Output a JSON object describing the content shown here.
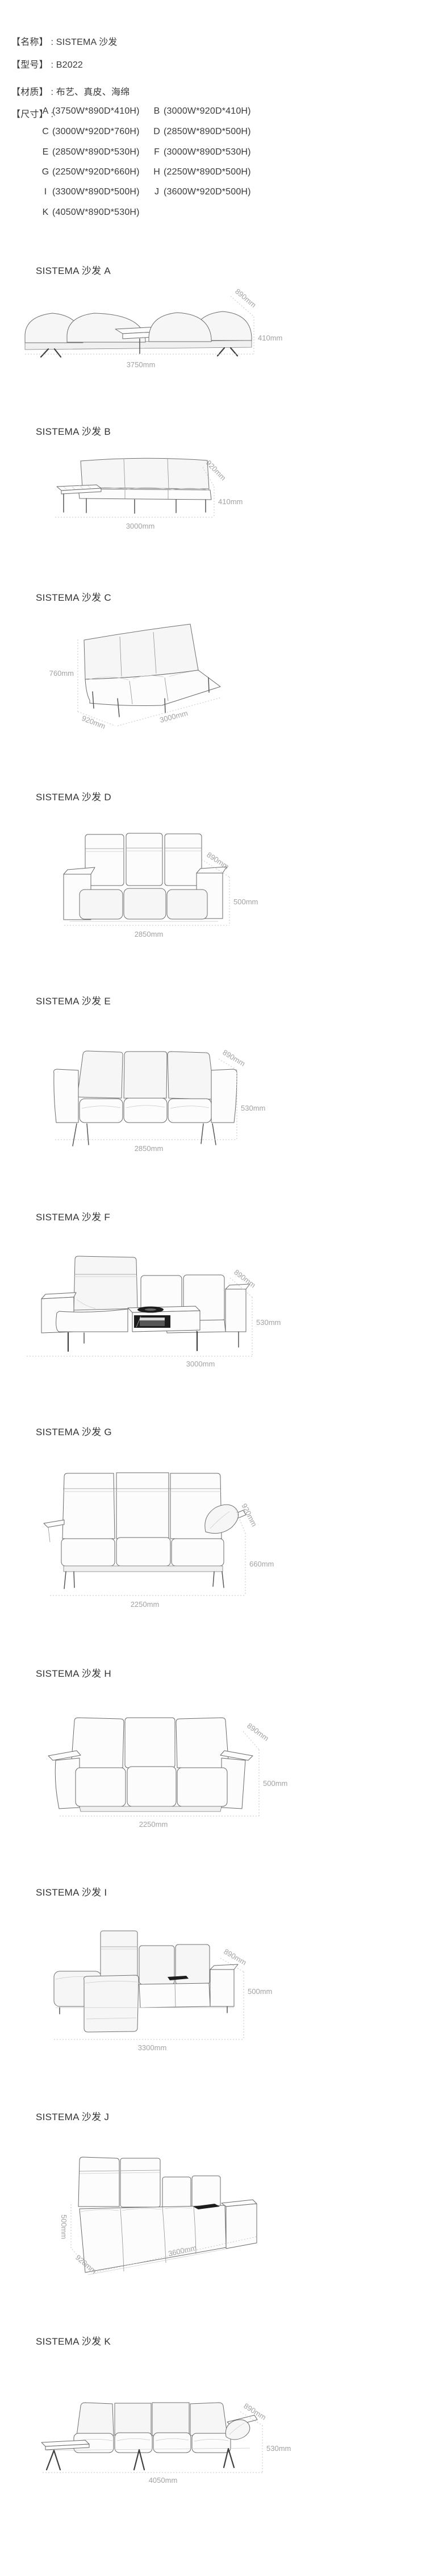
{
  "palette": {
    "text_color": "#3a3a3a",
    "dim_label_color": "#a2a2a2",
    "line_art_color": "#686868",
    "background": "#ffffff"
  },
  "header": {
    "rows": [
      {
        "label": "【名称】",
        "sep": " : ",
        "value": "SISTEMA 沙发"
      },
      {
        "label": "【型号】",
        "sep": " : ",
        "value": "B2022"
      },
      {
        "label": "【材质】",
        "sep": " : ",
        "value": "布艺、真皮、海绵"
      }
    ],
    "size_label": "【尺寸】",
    "size_sep": " : ",
    "sizes": [
      {
        "key": "A",
        "dims": "(3750W*890D*410H)"
      },
      {
        "key": "B",
        "dims": "(3000W*920D*410H)"
      },
      {
        "key": "C",
        "dims": "(3000W*920D*760H)"
      },
      {
        "key": "D",
        "dims": "(2850W*890D*500H)"
      },
      {
        "key": "E",
        "dims": "(2850W*890D*530H)"
      },
      {
        "key": "F",
        "dims": "(3000W*890D*530H)"
      },
      {
        "key": "G",
        "dims": "(2250W*920D*660H)"
      },
      {
        "key": "H",
        "dims": "(2250W*890D*500H)"
      },
      {
        "key": "I",
        "dims": "(3300W*890D*500H)"
      },
      {
        "key": "J",
        "dims": "(3600W*920D*500H)"
      },
      {
        "key": "K",
        "dims": "(4050W*890D*530H)"
      }
    ]
  },
  "sections": [
    {
      "id": "A",
      "title": "SISTEMA 沙发 A",
      "width": "3750mm",
      "depth": "890mm",
      "height": "410mm"
    },
    {
      "id": "B",
      "title": "SISTEMA 沙发 B",
      "width": "3000mm",
      "depth": "920mm",
      "height": "410mm"
    },
    {
      "id": "C",
      "title": "SISTEMA 沙发 C",
      "width": "3000mm",
      "depth": "920mm",
      "height": "760mm"
    },
    {
      "id": "D",
      "title": "SISTEMA 沙发 D",
      "width": "2850mm",
      "depth": "890mm",
      "height": "500mm"
    },
    {
      "id": "E",
      "title": "SISTEMA 沙发 E",
      "width": "2850mm",
      "depth": "890mm",
      "height": "530mm"
    },
    {
      "id": "F",
      "title": "SISTEMA 沙发 F",
      "width": "3000mm",
      "depth": "890mm",
      "height": "530mm"
    },
    {
      "id": "G",
      "title": "SISTEMA 沙发 G",
      "width": "2250mm",
      "depth": "920mm",
      "height": "660mm"
    },
    {
      "id": "H",
      "title": "SISTEMA 沙发 H",
      "width": "2250mm",
      "depth": "890mm",
      "height": "500mm"
    },
    {
      "id": "I",
      "title": "SISTEMA 沙发 I",
      "width": "3300mm",
      "depth": "890mm",
      "height": "500mm"
    },
    {
      "id": "J",
      "title": "SISTEMA 沙发 J",
      "width": "3600mm",
      "depth": "920mm",
      "height": "500mm"
    },
    {
      "id": "K",
      "title": "SISTEMA 沙发 K",
      "width": "4050mm",
      "depth": "890mm",
      "height": "530mm"
    }
  ]
}
